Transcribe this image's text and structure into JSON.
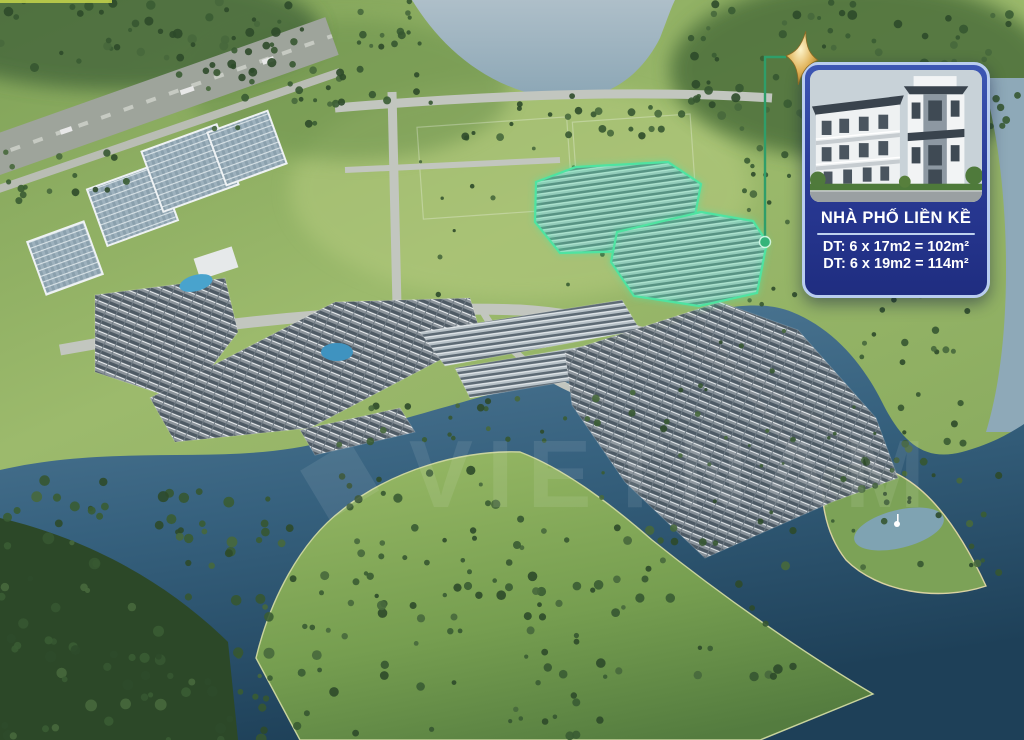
{
  "callout": {
    "title": "NHÀ PHỐ LIỀN KỀ",
    "spec_lines": [
      "DT: 6 x 17m2 = 102m²",
      "DT: 6 x 19m2 = 114m²"
    ]
  },
  "watermark": {
    "logo_glyph": "◆",
    "text": "VIETNAM"
  },
  "icons": {
    "marker": "sparkle-star-icon"
  },
  "colors": {
    "card_bg": "#2a3b97",
    "card_border": "#b9cdf0",
    "highlight_green": "#4fe3a1",
    "connector_green": "#2f9e6a",
    "star_gold": "#d9ab4e",
    "water_dark": "#24506e",
    "water_light": "#9db4c2"
  }
}
